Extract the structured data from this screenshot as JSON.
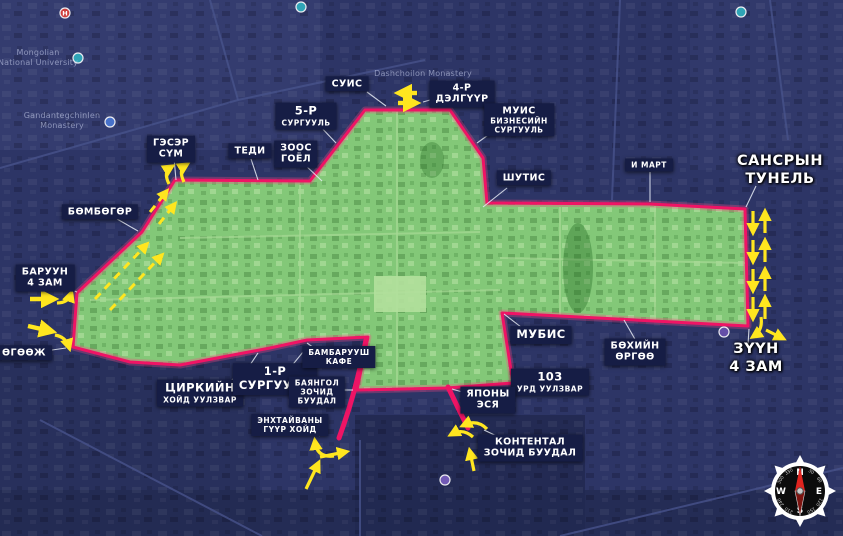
{
  "colors": {
    "navy_bg": "#2d3566",
    "zone_green": "#83c878",
    "boundary_magenta": "#ef1465",
    "arrow_yellow": "#ffe61f",
    "label_bg": "#161d45",
    "label_text": "#ffffff",
    "callout": "#e9edf7"
  },
  "map_labels": [
    {
      "id": "suis",
      "style": "boxed",
      "x": 347,
      "y": 84,
      "lines": [
        {
          "t": "СУИС"
        }
      ]
    },
    {
      "id": "delguur-4",
      "style": "boxed",
      "x": 462,
      "y": 94,
      "lines": [
        {
          "t": "4-Р"
        },
        {
          "t": "ДЭЛГҮҮР"
        }
      ]
    },
    {
      "id": "surguul-5",
      "style": "boxed",
      "x": 306,
      "y": 116,
      "lines": [
        {
          "t": "5-Р",
          "s": "big"
        },
        {
          "t": "СУРГУУЛЬ",
          "s": "small"
        }
      ]
    },
    {
      "id": "muis",
      "style": "boxed",
      "x": 519,
      "y": 120,
      "lines": [
        {
          "t": "МУИС"
        },
        {
          "t": "БИЗНЕСИЙН",
          "s": "small"
        },
        {
          "t": "СУРГУУЛЬ",
          "s": "small"
        }
      ]
    },
    {
      "id": "shutis",
      "style": "boxed",
      "x": 524,
      "y": 178,
      "lines": [
        {
          "t": "ШУТИС"
        }
      ]
    },
    {
      "id": "emart",
      "style": "boxed",
      "x": 649,
      "y": 165,
      "lines": [
        {
          "t": "И МАРТ",
          "s": "small"
        }
      ]
    },
    {
      "id": "zoos-goyol",
      "style": "boxed",
      "x": 296,
      "y": 154,
      "lines": [
        {
          "t": "ЗООС"
        },
        {
          "t": "ГОЁЛ"
        }
      ]
    },
    {
      "id": "geser-sum",
      "style": "boxed",
      "x": 171,
      "y": 149,
      "lines": [
        {
          "t": "ГЭСЭР"
        },
        {
          "t": "СҮМ"
        }
      ]
    },
    {
      "id": "tedi",
      "style": "boxed",
      "x": 250,
      "y": 151,
      "lines": [
        {
          "t": "ТЕДИ"
        }
      ]
    },
    {
      "id": "bumbugur",
      "style": "boxed",
      "x": 100,
      "y": 212,
      "lines": [
        {
          "t": "БӨМБӨГӨР"
        }
      ]
    },
    {
      "id": "baruun-4-zam",
      "style": "boxed",
      "x": 45,
      "y": 278,
      "lines": [
        {
          "t": "БАРУУН"
        },
        {
          "t": "4 ЗАМ"
        }
      ]
    },
    {
      "id": "uguuj",
      "style": "boxed",
      "x": 24,
      "y": 353,
      "lines": [
        {
          "t": "ӨГӨӨЖ"
        }
      ]
    },
    {
      "id": "tsirkiin",
      "style": "boxed",
      "x": 200,
      "y": 393,
      "lines": [
        {
          "t": "ЦИРКИЙН",
          "s": "big"
        },
        {
          "t": "ХОЙД УУЛЗВАР",
          "s": "small"
        }
      ]
    },
    {
      "id": "surguul-1",
      "style": "boxed",
      "x": 275,
      "y": 379,
      "lines": [
        {
          "t": "1-Р",
          "s": "big"
        },
        {
          "t": "СУРГУУЛЬ",
          "s": "big"
        }
      ]
    },
    {
      "id": "bambaruush",
      "style": "boxed",
      "x": 339,
      "y": 357,
      "lines": [
        {
          "t": "БАМБАРУУШ",
          "s": "small"
        },
        {
          "t": "КАФЕ",
          "s": "small"
        }
      ]
    },
    {
      "id": "bayangol",
      "style": "boxed",
      "x": 317,
      "y": 392,
      "lines": [
        {
          "t": "БАЯНГОЛ",
          "s": "small"
        },
        {
          "t": "ЗОЧИД",
          "s": "small"
        },
        {
          "t": "БУУДАЛ",
          "s": "small"
        }
      ]
    },
    {
      "id": "enkhtaivany",
      "style": "boxed",
      "x": 290,
      "y": 425,
      "lines": [
        {
          "t": "ЭНХТАЙВАНЫ",
          "s": "small"
        },
        {
          "t": "ГҮҮР ХОЙД",
          "s": "small"
        }
      ]
    },
    {
      "id": "mubis",
      "style": "boxed",
      "x": 541,
      "y": 335,
      "lines": [
        {
          "t": "МУБИС",
          "s": "big"
        }
      ]
    },
    {
      "id": "urd-103",
      "style": "boxed",
      "x": 550,
      "y": 382,
      "lines": [
        {
          "t": "103",
          "s": "big"
        },
        {
          "t": "УРД УУЛЗВАР",
          "s": "small"
        }
      ]
    },
    {
      "id": "yapony-esya",
      "style": "boxed",
      "x": 488,
      "y": 400,
      "lines": [
        {
          "t": "ЯПОНЫ"
        },
        {
          "t": "ЭСЯ"
        }
      ]
    },
    {
      "id": "kontental",
      "style": "boxed",
      "x": 530,
      "y": 448,
      "lines": [
        {
          "t": "КОНТЕНТАЛ"
        },
        {
          "t": "ЗОЧИД БУУДАЛ"
        }
      ]
    },
    {
      "id": "bukhiin-urguu",
      "style": "boxed",
      "x": 635,
      "y": 352,
      "lines": [
        {
          "t": "БӨХИЙН"
        },
        {
          "t": "ӨРГӨӨ"
        }
      ]
    },
    {
      "id": "zuun-4-zam",
      "style": "plain",
      "x": 756,
      "y": 358,
      "lines": [
        {
          "t": "ЗҮҮН"
        },
        {
          "t": "4 ЗАМ"
        }
      ]
    },
    {
      "id": "sansryn-tunel",
      "style": "plain",
      "x": 780,
      "y": 170,
      "lines": [
        {
          "t": "САНСРЫН"
        },
        {
          "t": "ТУНЕЛЬ"
        }
      ]
    },
    {
      "id": "bg-university",
      "style": "faint",
      "x": 38,
      "y": 58,
      "lines": [
        {
          "t": "Mongolian"
        },
        {
          "t": "National University"
        }
      ]
    },
    {
      "id": "bg-gandan",
      "style": "faint",
      "x": 62,
      "y": 121,
      "lines": [
        {
          "t": "Gandantegchinlen"
        },
        {
          "t": "Monastery"
        }
      ]
    },
    {
      "id": "bg-dashchoilon",
      "style": "faint",
      "x": 423,
      "y": 74,
      "lines": [
        {
          "t": "Dashchoilon Monastery"
        }
      ]
    }
  ],
  "compass": {
    "cardinals": [
      {
        "t": "N",
        "angle": 0
      },
      {
        "t": "E",
        "angle": 90
      },
      {
        "t": "S",
        "angle": 180
      },
      {
        "t": "W",
        "angle": 270
      }
    ],
    "degrees": [
      {
        "t": "30",
        "angle": 30
      },
      {
        "t": "60",
        "angle": 60
      },
      {
        "t": "120",
        "angle": 120
      },
      {
        "t": "150",
        "angle": 150
      },
      {
        "t": "210",
        "angle": 210
      },
      {
        "t": "240",
        "angle": 240
      },
      {
        "t": "300",
        "angle": 300
      },
      {
        "t": "330",
        "angle": 330
      }
    ]
  },
  "pins": [
    {
      "x": 65,
      "y": 13,
      "color": "#e04038",
      "letter": "H"
    },
    {
      "x": 78,
      "y": 58,
      "color": "#2fb0bf",
      "letter": ""
    },
    {
      "x": 110,
      "y": 122,
      "color": "#4a77d4",
      "letter": ""
    },
    {
      "x": 301,
      "y": 7,
      "color": "#2fb0bf",
      "letter": ""
    },
    {
      "x": 741,
      "y": 12,
      "color": "#2fb0bf",
      "letter": ""
    },
    {
      "x": 445,
      "y": 480,
      "color": "#7a5fc0",
      "letter": ""
    },
    {
      "x": 724,
      "y": 332,
      "color": "#6b52b0",
      "letter": ""
    }
  ]
}
